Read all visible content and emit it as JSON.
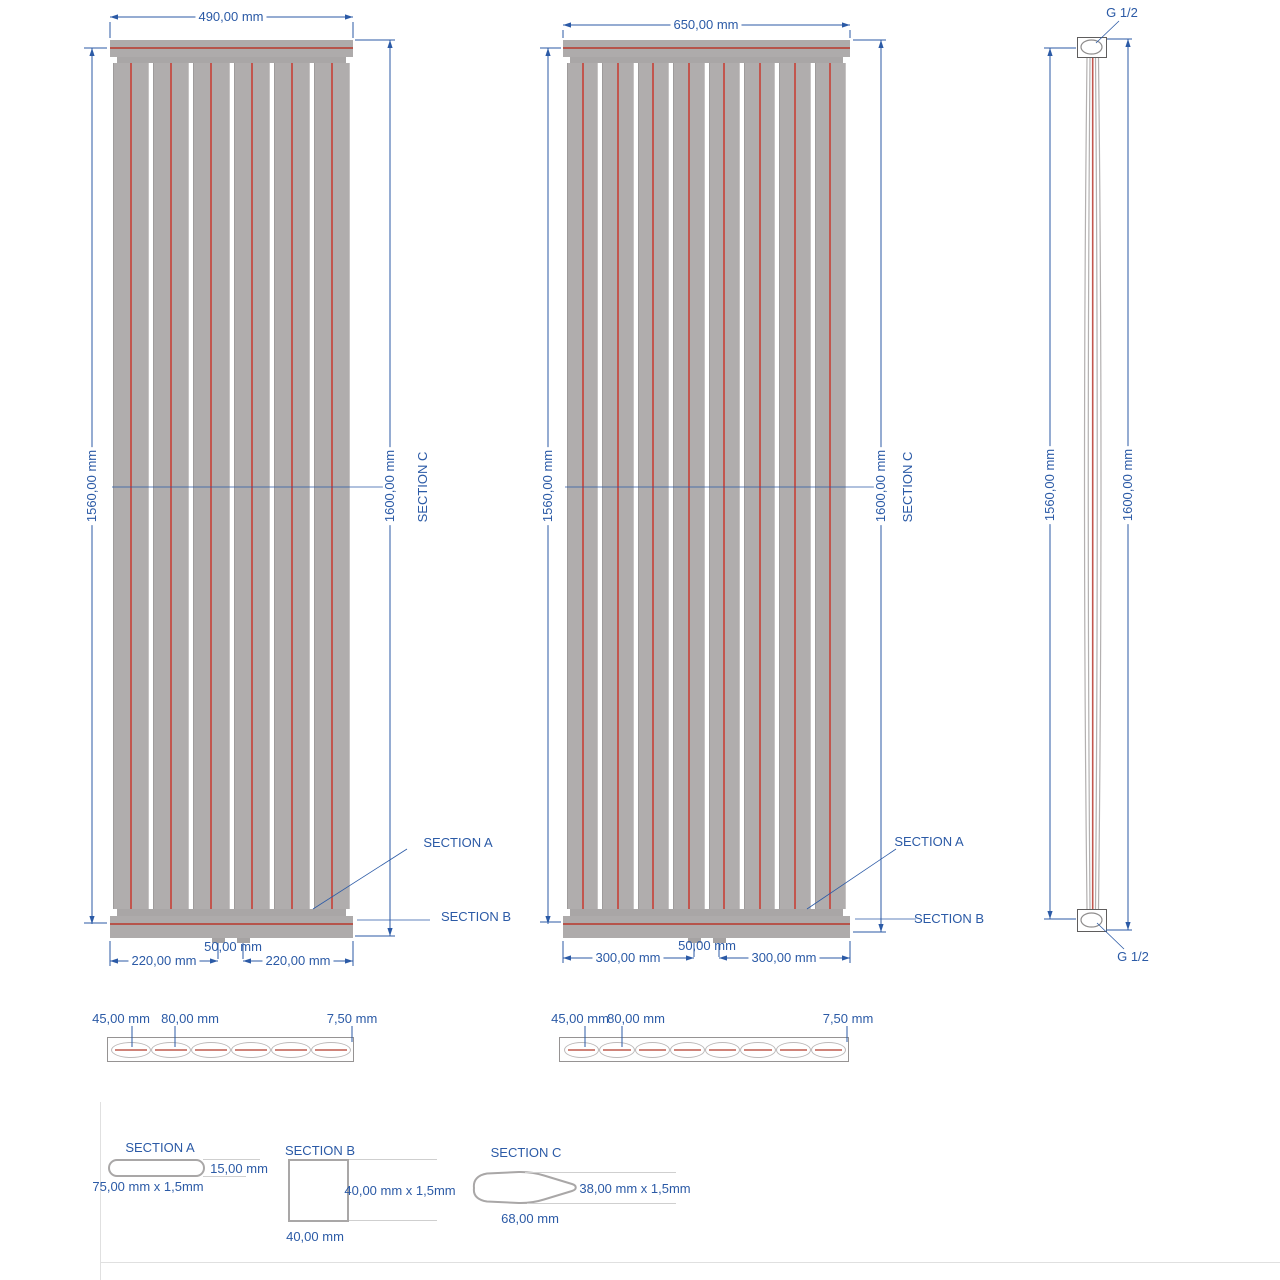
{
  "drawing": {
    "radiator_small": {
      "width_dim": "490,00 mm",
      "height_inner_dim": "1560,00 mm",
      "height_overall_dim": "1600,00 mm",
      "section_c_ref": "SECTION C",
      "section_a_ref": "SECTION A",
      "section_b_ref": "SECTION B",
      "conn_left_dim": "220,00 mm",
      "conn_spacing_dim": "50,00 mm",
      "conn_right_dim": "220,00 mm",
      "panel_count": 6
    },
    "radiator_large": {
      "width_dim": "650,00 mm",
      "height_inner_dim": "1560,00 mm",
      "height_overall_dim": "1600,00 mm",
      "section_c_ref": "SECTION C",
      "section_a_ref": "SECTION A",
      "section_b_ref": "SECTION B",
      "conn_left_dim": "300,00 mm",
      "conn_spacing_dim": "50,00 mm",
      "conn_right_dim": "300,00 mm",
      "panel_count": 8
    },
    "side_view": {
      "height_inner_dim": "1560,00 mm",
      "height_overall_dim": "1600,00 mm",
      "top_connection": "G 1/2",
      "bottom_connection": "G 1/2"
    },
    "plan_small": {
      "depth_dim": "45,00 mm",
      "panel_width_dim": "80,00 mm",
      "gap_dim": "7,50 mm",
      "element_count": 6
    },
    "plan_large": {
      "depth_dim": "45,00 mm",
      "panel_width_dim": "80,00 mm",
      "gap_dim": "7,50 mm",
      "element_count": 8
    },
    "section_a": {
      "title": "SECTION A",
      "height_dim": "15,00 mm",
      "size_dim": "75,00 mm x 1,5mm"
    },
    "section_b": {
      "title": "SECTION B",
      "size_dim": "40,00 mm x 1,5mm",
      "width_dim": "40,00 mm"
    },
    "section_c": {
      "title": "SECTION C",
      "size_dim": "38,00 mm x 1,5mm",
      "width_dim": "68,00 mm"
    }
  },
  "colors": {
    "dimension_blue": "#2b5aa6",
    "metal_gray": "#b0adad",
    "channel_red": "#c2564e",
    "outline_gray": "#a9a7a7"
  }
}
